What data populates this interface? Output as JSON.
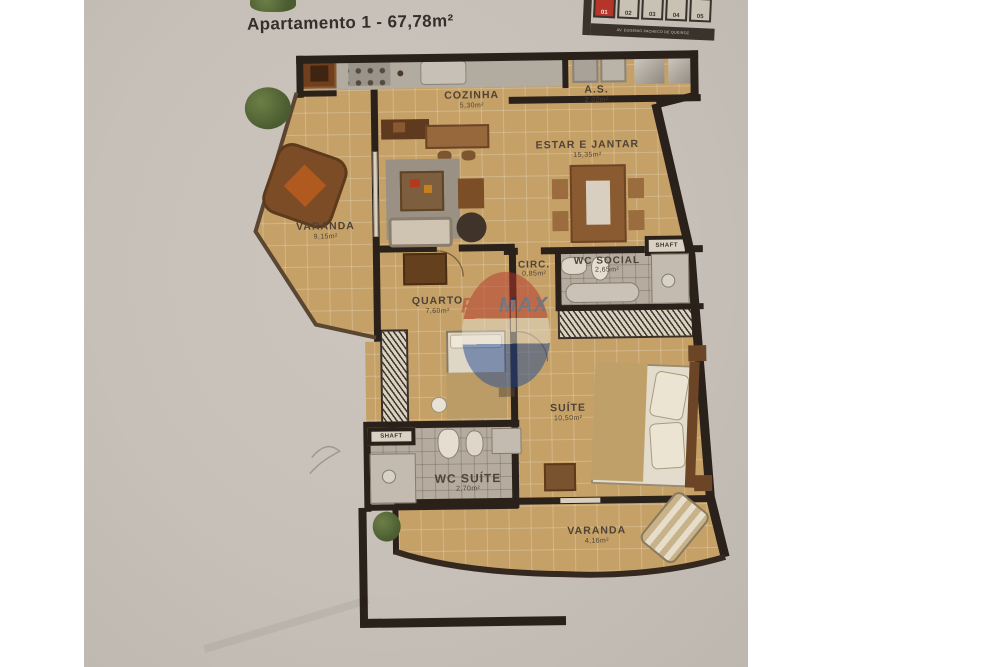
{
  "title": "Apartamento 1 - 67,78m²",
  "key_map": {
    "units": [
      "01",
      "02",
      "03",
      "04",
      "05"
    ],
    "highlighted_unit": "01",
    "street": "AV. EUGENIO PACHECO DE QUEIROZ",
    "highlight_color": "#b5352a"
  },
  "rooms": {
    "cozinha": {
      "name": "COZINHA",
      "area": "5,30m²"
    },
    "as": {
      "name": "A.S.",
      "area": "2,02m²"
    },
    "estar": {
      "name": "ESTAR E JANTAR",
      "area": "15,35m²"
    },
    "varanda1": {
      "name": "VARANDA",
      "area": "9,15m²"
    },
    "circ": {
      "name": "CIRC.",
      "area": "0,85m²"
    },
    "wc_social": {
      "name": "WC SOCIAL",
      "area": "2,65m²"
    },
    "quarto": {
      "name": "QUARTO",
      "area": "7,60m²"
    },
    "suite": {
      "name": "SUÍTE",
      "area": "10,50m²"
    },
    "wc_suite": {
      "name": "WC SUÍTE",
      "area": "2,70m²"
    },
    "varanda2": {
      "name": "VARANDA",
      "area": "4,16m²"
    },
    "shaft_top": {
      "name": "SHAFT"
    },
    "shaft_bottom": {
      "name": "SHAFT"
    }
  },
  "watermark": {
    "re": "RE",
    "slash": "/",
    "max": "MAX",
    "colors": {
      "re": "#b5352a",
      "max": "#234a94"
    }
  },
  "colors": {
    "wall": "#2a211a",
    "floor": "#c5a167",
    "bath_tile": "#b5ab9f",
    "paper": "#c6c0b8",
    "accent_red": "#b5352a",
    "accent_blue": "#234a94"
  }
}
